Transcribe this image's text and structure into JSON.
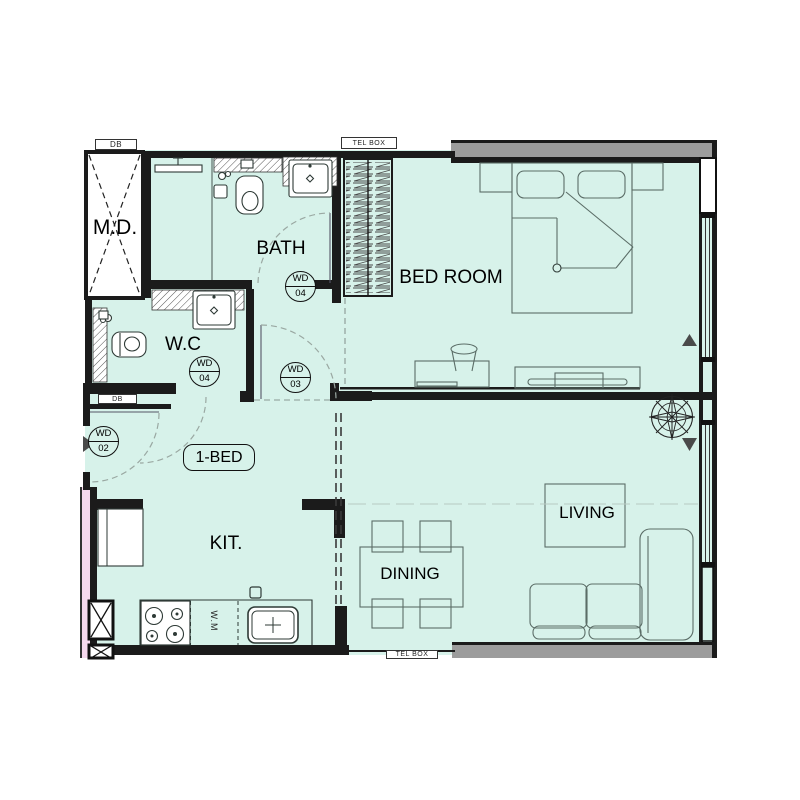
{
  "plan": {
    "unit_tag": "1-BED",
    "rooms": [
      {
        "id": "md",
        "label": "M.D."
      },
      {
        "id": "bath",
        "label": "BATH"
      },
      {
        "id": "wc",
        "label": "W.C"
      },
      {
        "id": "bedroom",
        "label": "BED ROOM"
      },
      {
        "id": "kitchen",
        "label": "KIT."
      },
      {
        "id": "dining",
        "label": "DINING"
      },
      {
        "id": "living",
        "label": "LIVING"
      }
    ],
    "door_tags": [
      {
        "id": "wd04-bath",
        "line1": "WD",
        "line2": "04"
      },
      {
        "id": "wd04-wc",
        "line1": "WD",
        "line2": "04"
      },
      {
        "id": "wd03",
        "line1": "WD",
        "line2": "03"
      },
      {
        "id": "wd02",
        "line1": "WD",
        "line2": "02"
      }
    ],
    "utility_labels": [
      {
        "id": "db-top",
        "text": "DB"
      },
      {
        "id": "telbox-top",
        "text": "TEL BOX"
      },
      {
        "id": "db-hall",
        "text": "DB"
      },
      {
        "id": "telbox-bottom",
        "text": "TEL BOX"
      },
      {
        "id": "washing-machine",
        "text": "W.M"
      }
    ],
    "colors": {
      "floor": "#d7f2ea",
      "corridor": "#f6d9ee",
      "wall": "#1b1b1b",
      "structure_gray": "#9c9c9c",
      "furniture_line": "#5b6d67"
    }
  }
}
